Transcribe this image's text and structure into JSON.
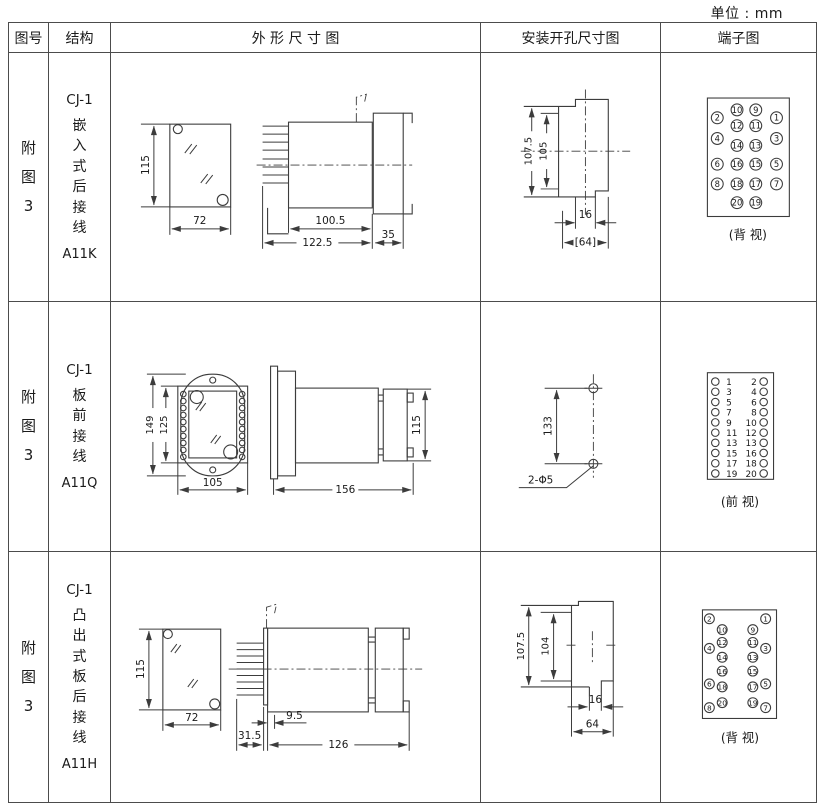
{
  "unit_label": "单位 : mm",
  "headers": {
    "fig_no": "图号",
    "structure": "结构",
    "outline": "外 形 尺 寸 图",
    "install": "安装开孔尺寸图",
    "terminal": "端子图"
  },
  "rows": [
    {
      "fig": [
        "附",
        "图",
        "3"
      ],
      "model": "CJ-1",
      "structure": [
        "嵌",
        "入",
        "式",
        "后",
        "接",
        "线"
      ],
      "code": "A11K",
      "dims": {
        "front_h": "115",
        "front_w": "72",
        "body_l": "100.5",
        "total_l": "122.5",
        "bezel": "35"
      },
      "install": {
        "h1": "107.5",
        "h2": "105",
        "slot": "16",
        "w": "[64]"
      },
      "terminal_caption": "(背 视)",
      "pins": {
        "inner_left": [
          "10",
          "12",
          "14",
          "16",
          "18",
          "20"
        ],
        "inner_right": [
          "9",
          "11",
          "13",
          "15",
          "17",
          "19"
        ],
        "outer_left": [
          "2",
          "4",
          "6",
          "8"
        ],
        "outer_right": [
          "1",
          "3",
          "5",
          "7"
        ]
      }
    },
    {
      "fig": [
        "附",
        "图",
        "3"
      ],
      "model": "CJ-1",
      "structure": [
        "板",
        "前",
        "接",
        "线"
      ],
      "code": "A11Q",
      "dims": {
        "front_h": "149",
        "front_h2": "125",
        "front_w": "105",
        "side_l": "156",
        "side_h": "115"
      },
      "install": {
        "pitch": "133",
        "holes": "2-Φ5"
      },
      "terminal_caption": "(前 视)",
      "pins": {
        "left": [
          "1",
          "3",
          "5",
          "7",
          "9",
          "11",
          "13",
          "15",
          "17",
          "19"
        ],
        "right": [
          "2",
          "4",
          "6",
          "8",
          "10",
          "12",
          "13",
          "16",
          "18",
          "20"
        ]
      }
    },
    {
      "fig": [
        "附",
        "图",
        "3"
      ],
      "model": "CJ-1",
      "structure": [
        "凸",
        "出",
        "式",
        "板",
        "后",
        "接",
        "线"
      ],
      "code": "A11H",
      "dims": {
        "front_h": "115",
        "front_w": "72",
        "pin_l": "31.5",
        "plate": "9.5",
        "total_l": "126"
      },
      "install": {
        "h1": "107.5",
        "h2": "104",
        "slot": "16",
        "w": "64"
      },
      "terminal_caption": "(背 视)",
      "pins": {
        "inner_left": [
          "10",
          "12",
          "14",
          "16",
          "18",
          "20"
        ],
        "inner_right": [
          "9",
          "11",
          "13",
          "15",
          "17",
          "19"
        ],
        "outer_left": [
          "2",
          "4",
          "6",
          "8"
        ],
        "outer_right": [
          "1",
          "3",
          "5",
          "7"
        ]
      }
    }
  ]
}
